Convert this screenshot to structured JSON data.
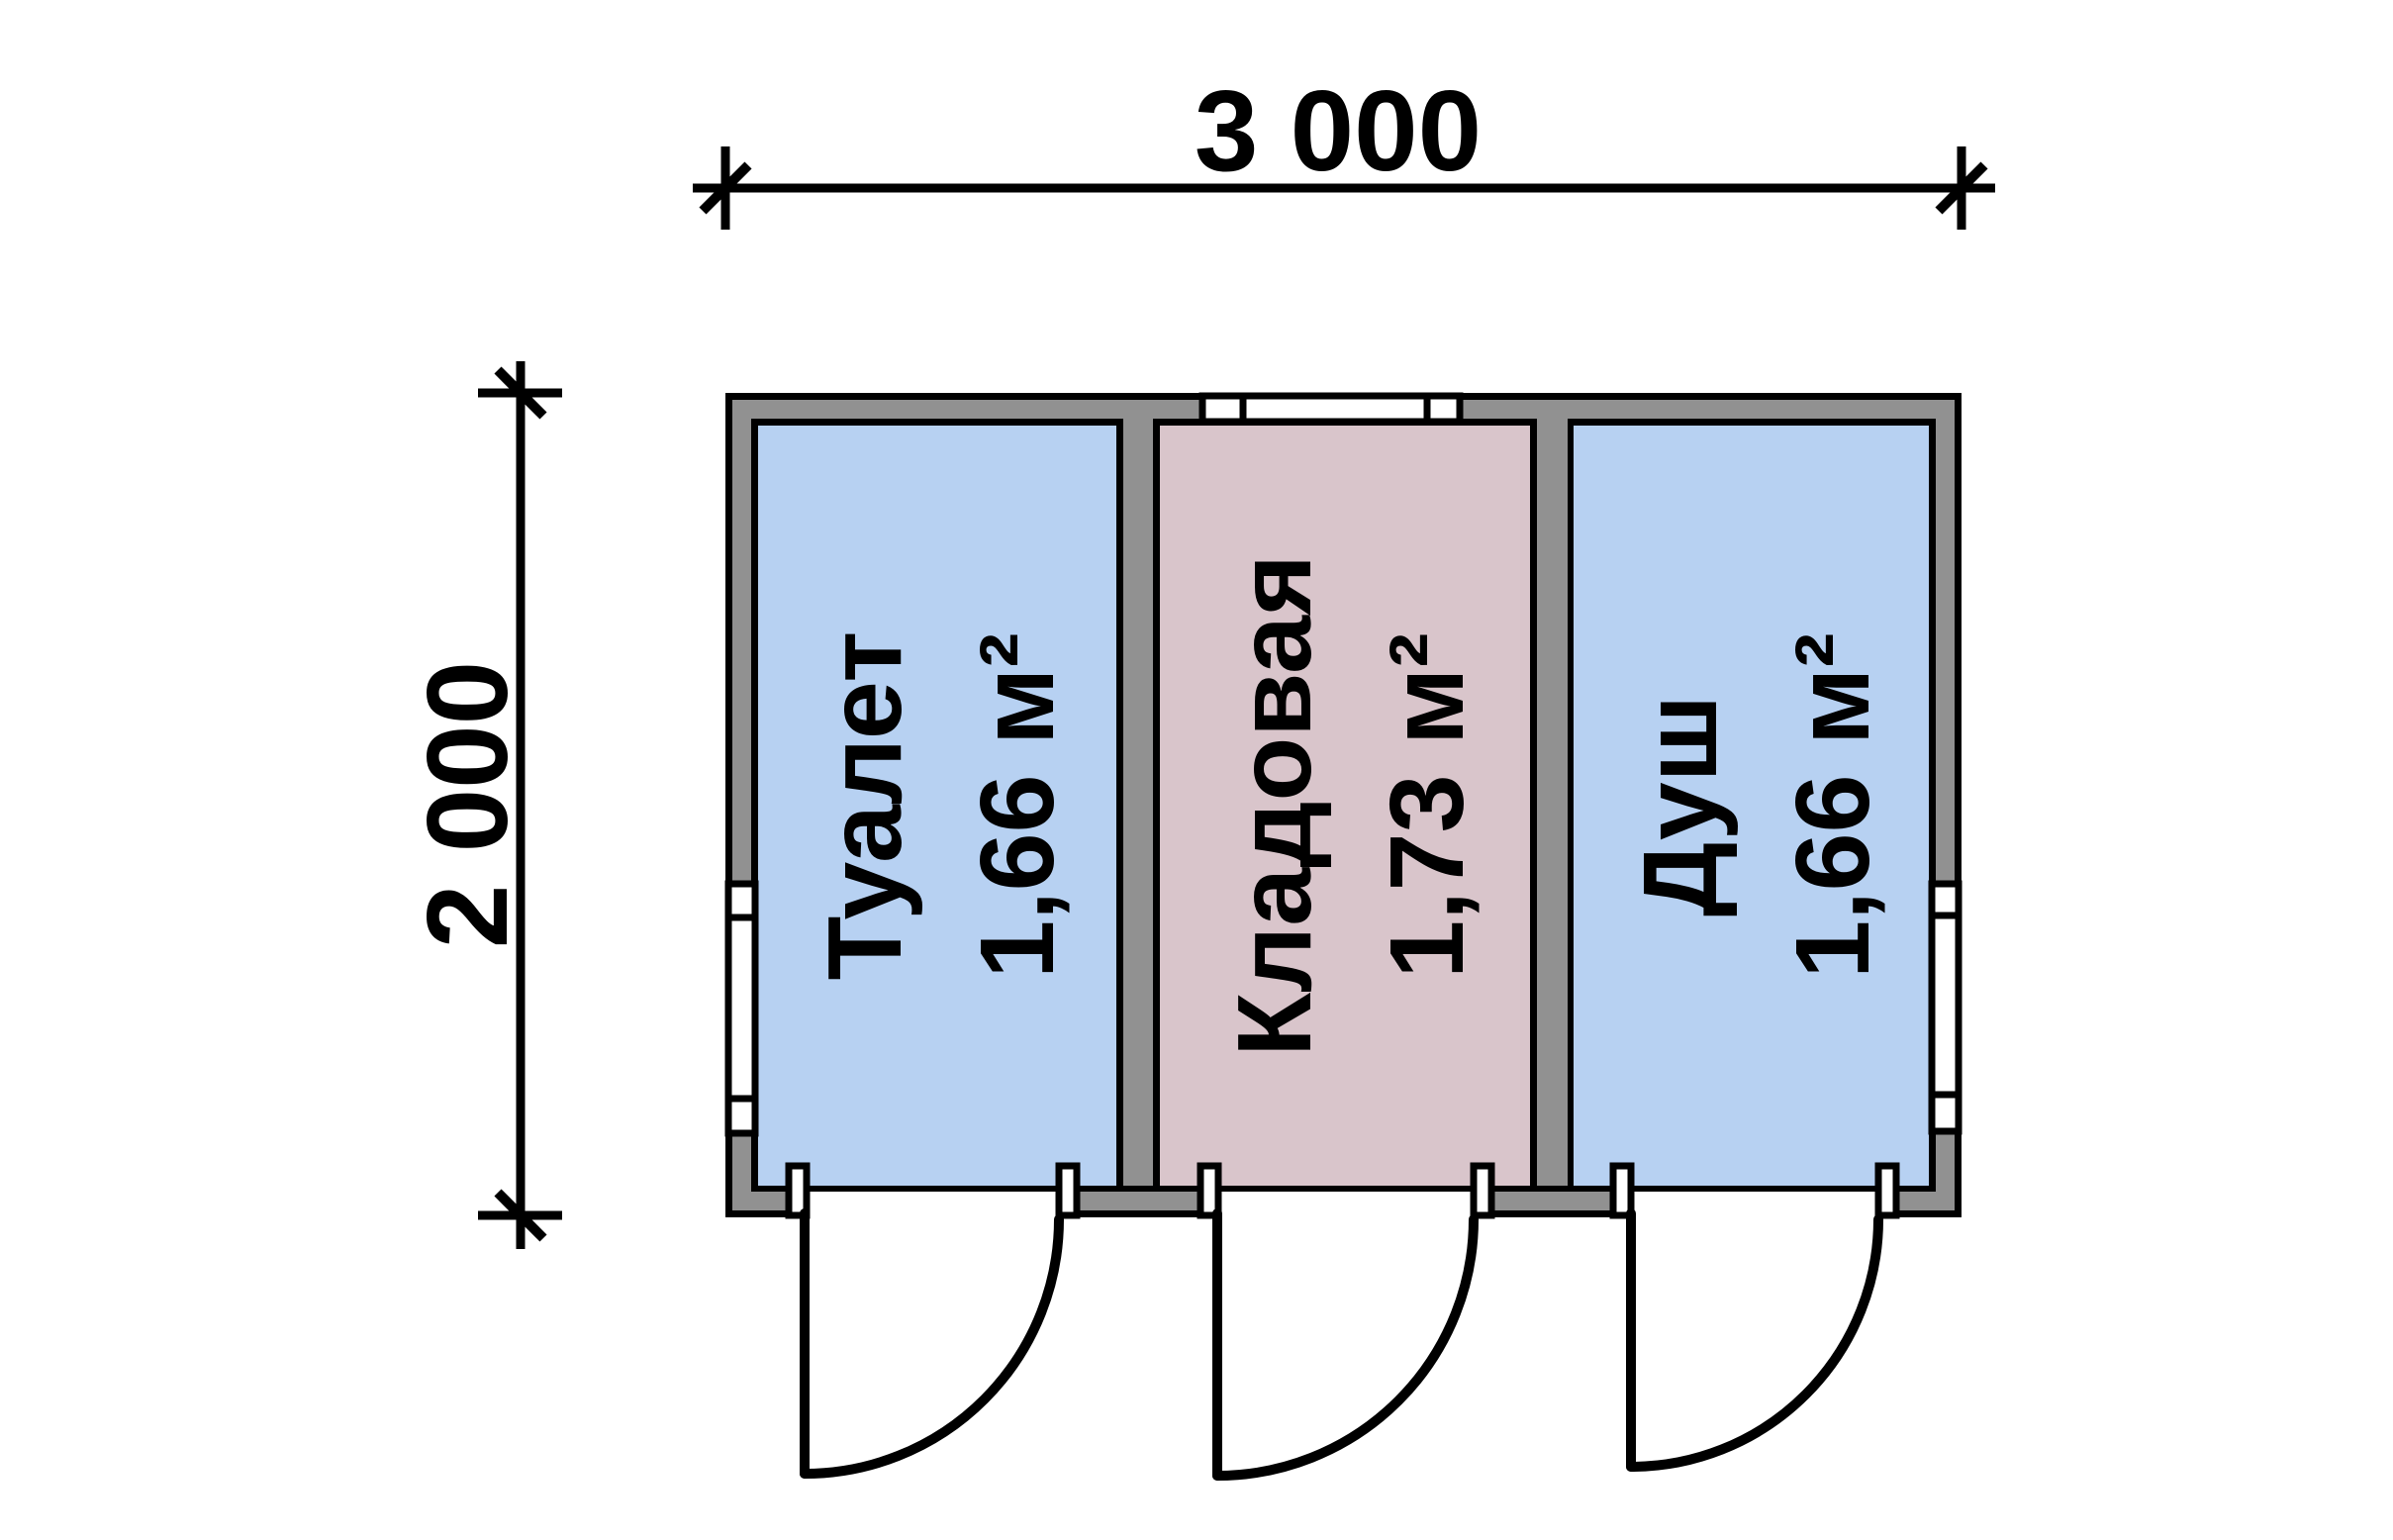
{
  "plan": {
    "dimensions": {
      "width_label": "3 000",
      "height_label": "2 000"
    },
    "rooms": [
      {
        "name": "Туалет",
        "area": "1,66 м²",
        "fill": "#b7d1f2"
      },
      {
        "name": "Кладовая",
        "area": "1,73 м²",
        "fill": "#d9c5cb"
      },
      {
        "name": "Душ",
        "area": "1,66 м²",
        "fill": "#b7d1f2"
      }
    ],
    "colors": {
      "wall": "#919191",
      "line": "#000000",
      "background": "#ffffff"
    }
  }
}
